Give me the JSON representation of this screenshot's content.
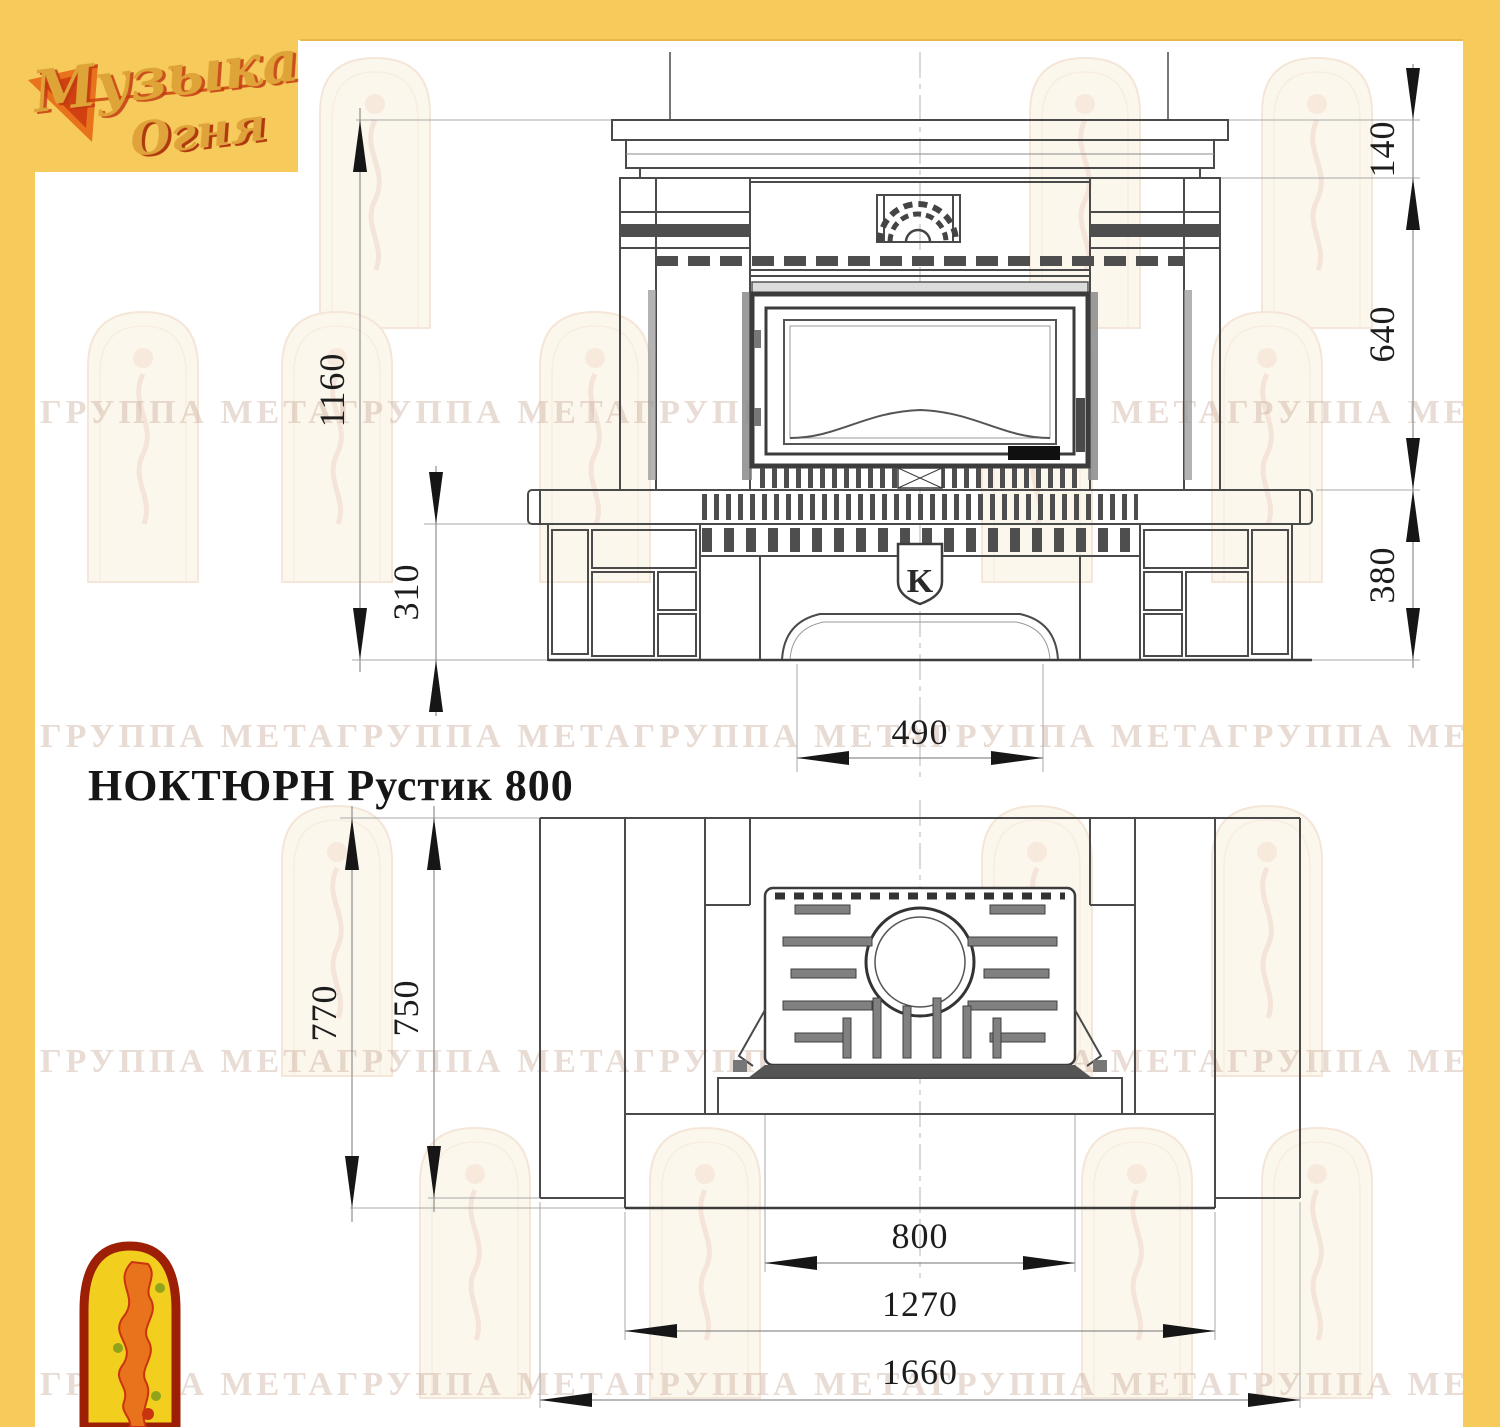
{
  "brand": {
    "logo_line1": "Музыка",
    "logo_line2": "Огня",
    "watermark_text": "ГРУППА МЕТА",
    "watermark_row": "ГРУППА МЕТАГРУППА МЕТАГРУППА МЕТАГРУППА МЕТАГРУППА МЕТА"
  },
  "title": "НОКТЮРН Рустик 800",
  "colors": {
    "frame": "#F6CB5C",
    "frame_edge": "#E8B84A",
    "emblem_red": "#9C1F06",
    "emblem_yellow": "#F2CE1E",
    "flame_orange": "#E8731C",
    "flame_red": "#C9330E"
  },
  "front_view": {
    "dimensions": {
      "total_height": "1160",
      "plinth_height": "310",
      "shelf_height": "140",
      "firebox_zone_height": "640",
      "base_zone_height": "380",
      "arch_width": "490"
    },
    "insert_mark": "K"
  },
  "plan_view": {
    "dimensions": {
      "depth_total": "770",
      "depth_body": "750",
      "firebox_width": "800",
      "body_width": "1270",
      "total_width": "1660"
    }
  }
}
